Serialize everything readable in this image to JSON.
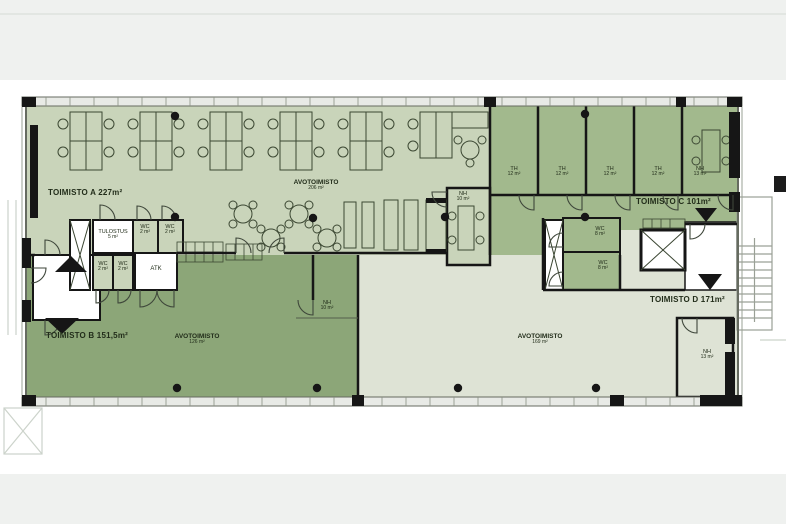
{
  "title": "Office floor plan (Toimisto pohjapiirros)",
  "colors": {
    "zone_toimisto_a": "#c9d4ba",
    "zone_toimisto_b": "#8ca678",
    "zone_toimisto_c": "#a2b98d",
    "zone_light": "#dee3d5",
    "wall": "#161616",
    "background_band": "#eff1ef"
  },
  "rooms": {
    "toimisto_a": {
      "label": "TOIMISTO A 227m²"
    },
    "toimisto_b": {
      "label": "TOIMISTO B 151,5m²"
    },
    "toimisto_c": {
      "label": "TOIMISTO C 101m²"
    },
    "toimisto_d": {
      "label": "TOIMISTO D 171m²"
    },
    "avotoimisto_a": {
      "label": "AVOTOIMISTO",
      "area": "206 m²"
    },
    "avotoimisto_b": {
      "label": "AVOTOIMISTO",
      "area": "126 m²"
    },
    "avotoimisto_d": {
      "label": "AVOTOIMISTO",
      "area": "169 m²"
    },
    "tulostus": {
      "label": "TULOSTUS",
      "area": "5 m²"
    },
    "atk": {
      "label": "ATK"
    },
    "th": {
      "label": "TH",
      "area": "12 m²"
    },
    "nh_10": {
      "label": "NH",
      "area": "10 m²"
    },
    "nh_13": {
      "label": "NH",
      "area": "13 m²"
    },
    "wc_2": {
      "label": "WC",
      "area": "2 m²"
    },
    "wc_8": {
      "label": "WC",
      "area": "8 m²"
    }
  }
}
